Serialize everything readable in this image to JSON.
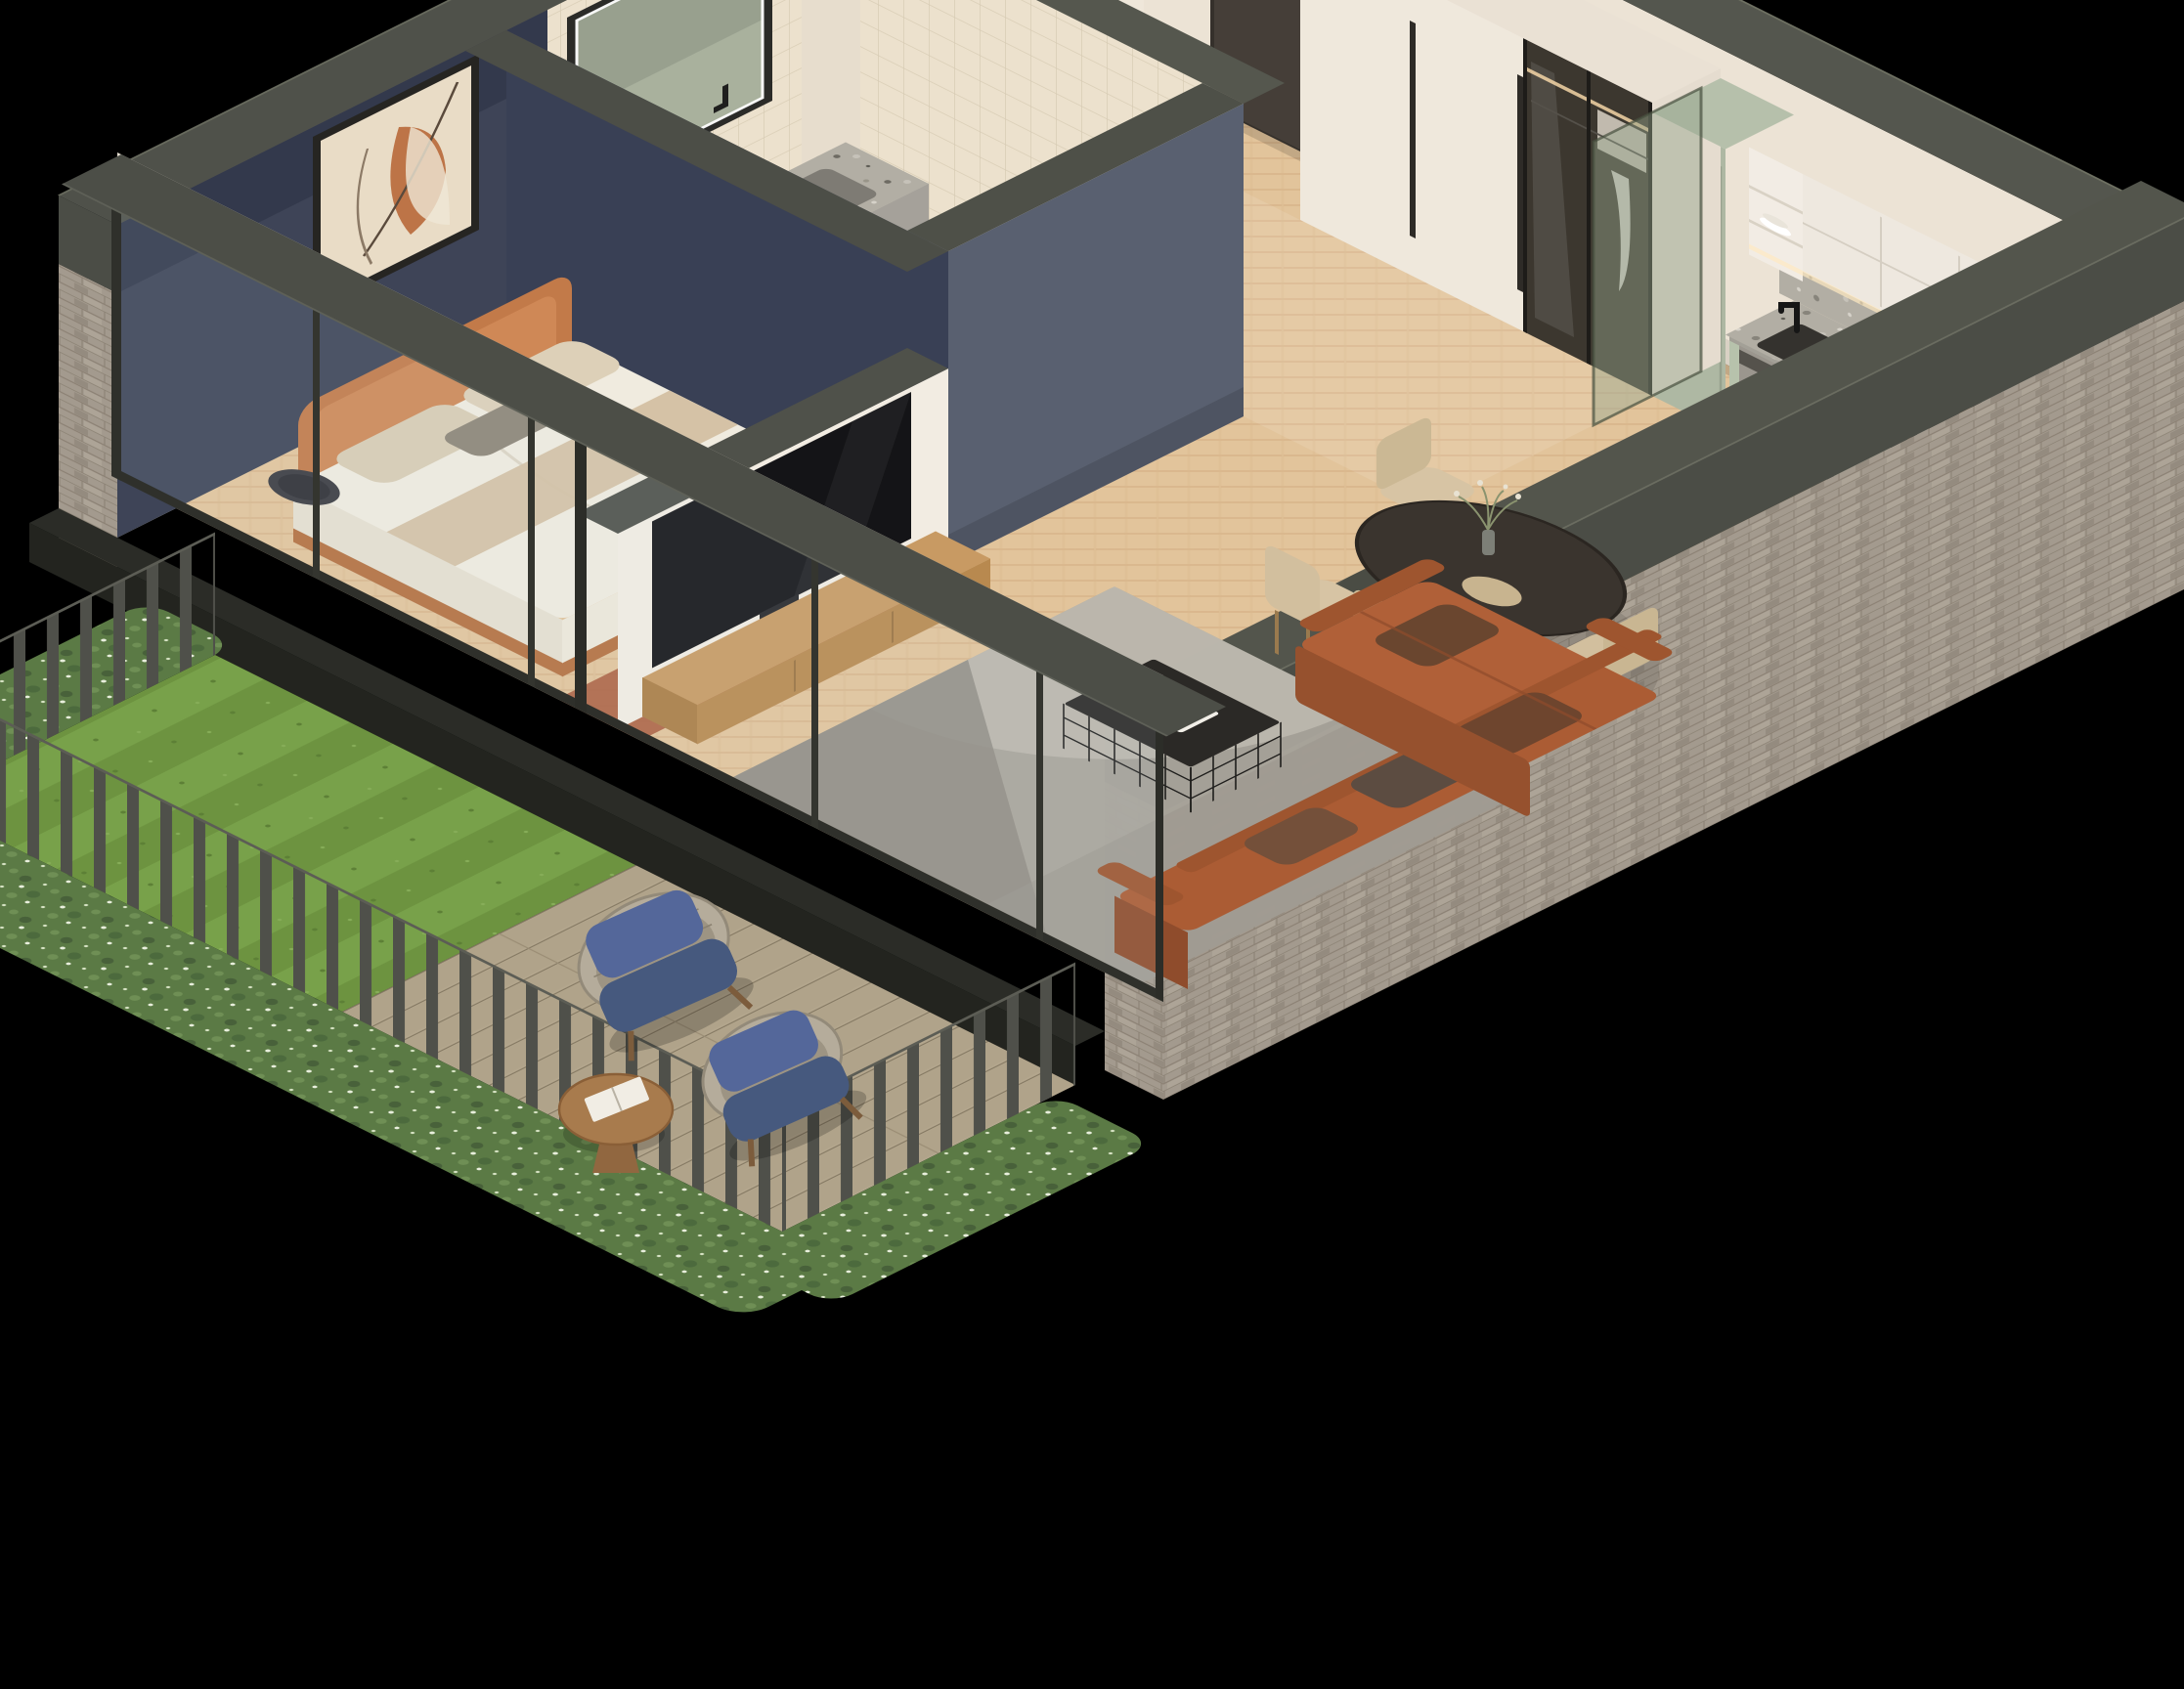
{
  "scene": {
    "type": "isometric-apartment-cutaway-render",
    "label": "3D isometric cutaway rendering of a one-bedroom apartment with private garden terrace",
    "background": "#000000",
    "camera": "isometric from south",
    "rooms": {
      "entry": {
        "label": "Entrance hallway",
        "items": [
          "dark front door with metal handle",
          "tall white storage cabinet",
          "wardrobe with white panels and smoked glass sliding doors"
        ]
      },
      "bathroom": {
        "label": "Bathroom",
        "items": [
          "cream tiled walls",
          "LED backlit mirror",
          "terrazzo double vanity with black wall faucets",
          "wall-hung toilet with flush plate",
          "freestanding bathtub with dark towel",
          "potted palm plant",
          "terrazzo floor"
        ]
      },
      "bedroom": {
        "label": "Bedroom",
        "items": [
          "double bed with caramel leather wrap headboard",
          "white bedding with beige pillows and throw",
          "abstract wall art on navy wall",
          "round black side table",
          "terracotta rug"
        ]
      },
      "kitchen": {
        "label": "Kitchen",
        "items": [
          "sage green base cabinets",
          "tall sage cabinet",
          "white upper cabinets",
          "open shelf with dishes",
          "terrazzo countertop and backsplash",
          "black undermount sink with black faucet",
          "induction hob",
          "built-in oven",
          "open dishwasher",
          "wooden cutting boards",
          "amber bottle",
          "green glass partition"
        ]
      },
      "living_dining": {
        "label": "Living and dining area",
        "items": [
          "oval dark wood dining table",
          "vase with dried flowers",
          "four beige dining chairs",
          "rust velvet sectional sofa with chaise",
          "black wire-frame coffee table with books",
          "patterned gray rug",
          "TV on low white partition wall",
          "oak media console",
          "herringbone oak floor"
        ]
      },
      "garden": {
        "label": "Garden terrace",
        "items": [
          "mown striped lawn",
          "timber deck",
          "two woven lounge chairs with navy cushions",
          "round wooden coffee table with magazines",
          "dark slatted fence",
          "white flowering hedge"
        ]
      }
    },
    "materials": {
      "wood_floor": "#e2c49b",
      "herringbone_line": "#cfa77c",
      "wall_cream": "#ece3d5",
      "wall_navy": "#3e4457",
      "wall_cap_dark": "#54564e",
      "bath_block_gray": "#596070",
      "brick_gray": "#a39a8e",
      "slate_blue": "#59626e",
      "sage_cabinet": "#b7c2ac",
      "terrazzo": "#b2aea4",
      "sofa_rust": "#a85a35",
      "leather_tan": "#c57d4b",
      "door_brown": "#453e38",
      "lawn_green": "#6d9340",
      "deck_wood": "#b3a68d",
      "cushion_blue": "#4d6390",
      "glass_tint": "rgba(210,228,240,0.10)"
    }
  }
}
